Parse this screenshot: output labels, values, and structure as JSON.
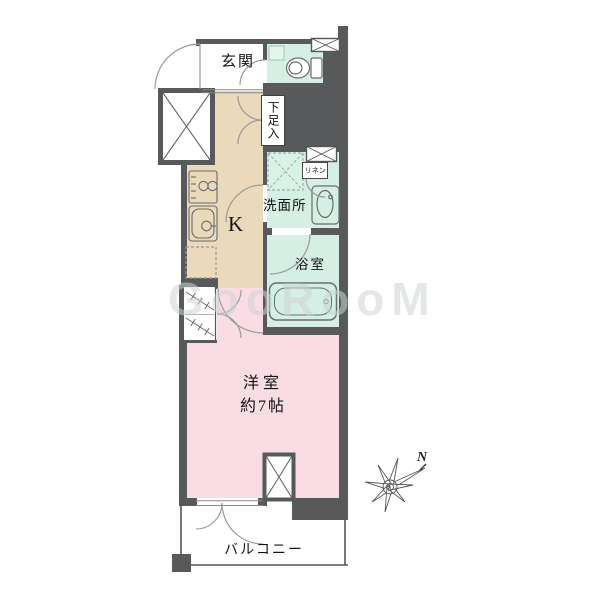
{
  "plan": {
    "watermark": "GooRooM",
    "compass": {
      "north_label": "N"
    },
    "rooms": {
      "genkan": {
        "label": "玄関"
      },
      "shoe_storage": {
        "label": "下足入"
      },
      "kitchen": {
        "label": "K"
      },
      "washroom": {
        "label": "洗面所"
      },
      "linen": {
        "label": "リネン"
      },
      "bathroom": {
        "label": "浴室"
      },
      "western_room": {
        "label": "洋室",
        "size": "約7帖"
      },
      "balcony": {
        "label": "バルコニー"
      }
    },
    "colors": {
      "wall": "#58595b",
      "wet_area": "#d6efe4",
      "kitchen_floor": "#ead9bb",
      "room_floor": "#f9dce4",
      "balcony_floor": "#ffffff",
      "fixture_line": "#6b6b6b",
      "door_arc": "#9a9a9a"
    },
    "icons": [
      "toilet-icon",
      "stove-icon",
      "kitchen-sink-icon",
      "washbasin-icon",
      "bathtub-icon",
      "washing-machine-space-icon",
      "refrigerator-space-icon",
      "closet-hanger-icon",
      "pipe-space-x-icon",
      "vent-hatch-icon",
      "door-swing-arc-icon",
      "compass-rose-icon"
    ]
  }
}
